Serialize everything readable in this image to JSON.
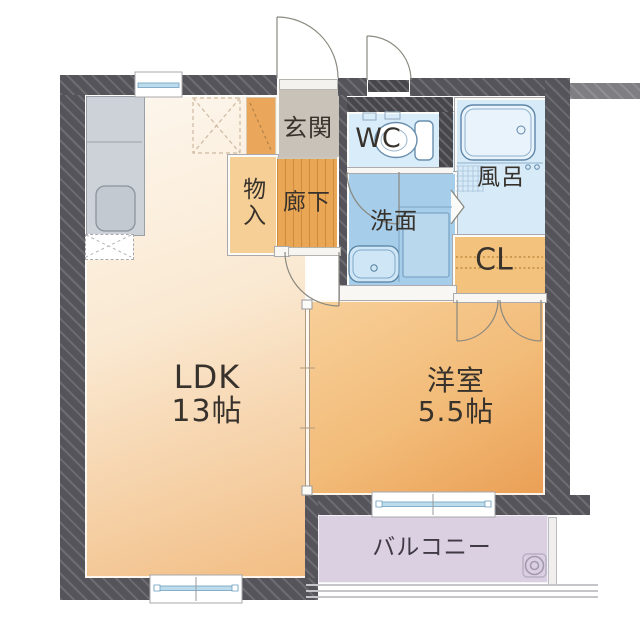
{
  "plan": {
    "type": "apartment-floor-plan",
    "rooms": {
      "ldk": {
        "label": "LDK",
        "size": "13帖"
      },
      "western_room": {
        "label": "洋室",
        "size": "5.5帖"
      },
      "entrance": {
        "label": "玄関"
      },
      "hallway": {
        "label": "廊下"
      },
      "storage": {
        "label": "物入"
      },
      "toilet": {
        "label": "WC"
      },
      "bath": {
        "label": "風呂"
      },
      "washroom": {
        "label": "洗面"
      },
      "closet": {
        "label": "CL"
      },
      "balcony": {
        "label": "バルコニー"
      }
    },
    "colors": {
      "wall": "#54545a",
      "ldk_floor": "#f6d8ae",
      "western_floor": "#efb470",
      "hallway_floor": "#e9a654",
      "entrance_floor": "#c8c2b8",
      "washroom_floor": "#a6cde9",
      "bath_floor": "#d7eaf8",
      "wc_floor": "#d9ecf9",
      "closet_floor": "#f3c37e",
      "balcony_floor": "#dbcfe2",
      "window_glass": "#bcdcec",
      "text": "#37322c"
    },
    "icons": [
      "toilet-icon",
      "bathtub-icon",
      "kitchen-sink-icon",
      "washbasin-icon",
      "washer-space-icon",
      "refrigerator-box-icon",
      "balcony-drain-icon",
      "door-swing-icon",
      "folding-door-icon",
      "sliding-door-icon",
      "sliding-window-icon",
      "closet-shelf-dashes",
      "tile-grid-icon"
    ]
  }
}
